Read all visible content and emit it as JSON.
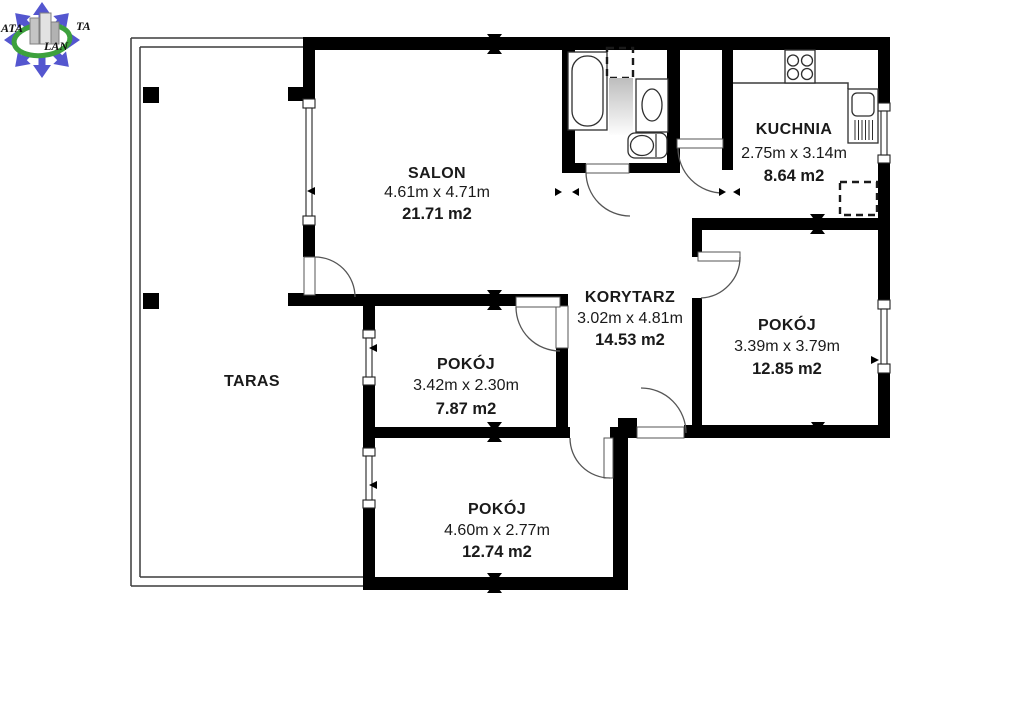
{
  "logo": {
    "text_left": "ATA",
    "text_right": "TA",
    "text_bottom": "LAN",
    "arrow_color": "#5456cf",
    "ring_color": "#3da13d",
    "building_color": "#c8c8c8"
  },
  "rooms": {
    "salon": {
      "name": "SALON",
      "dims": "4.61m x 4.71m",
      "area": "21.71 m2"
    },
    "kuchnia": {
      "name": "KUCHNIA",
      "dims": "2.75m x 3.14m",
      "area": "8.64 m2"
    },
    "korytarz": {
      "name": "KORYTARZ",
      "dims": "3.02m x 4.81m",
      "area": "14.53 m2"
    },
    "pokoj_right": {
      "name": "POKÓJ",
      "dims": "3.39m x 3.79m",
      "area": "12.85 m2"
    },
    "pokoj_small": {
      "name": "POKÓJ",
      "dims": "3.42m x 2.30m",
      "area": "7.87 m2"
    },
    "pokoj_bottom": {
      "name": "POKÓJ",
      "dims": "4.60m x 2.77m",
      "area": "12.74 m2"
    },
    "taras": {
      "name": "TARAS"
    }
  },
  "colors": {
    "wall": "#000000",
    "background": "#ffffff"
  }
}
